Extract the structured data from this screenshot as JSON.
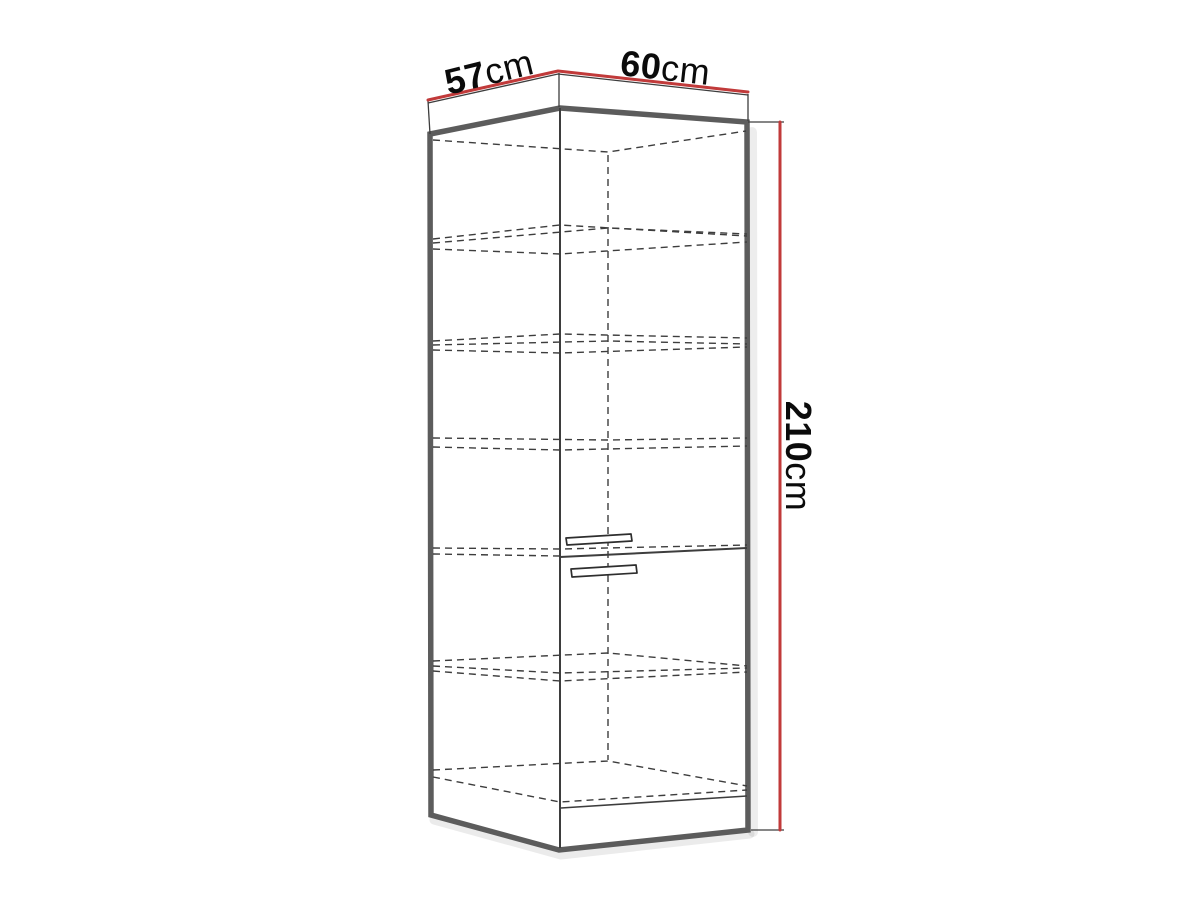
{
  "diagram": {
    "labels": {
      "depth": {
        "value": "57",
        "unit": "cm"
      },
      "width": {
        "value": "60",
        "unit": "cm"
      },
      "height": {
        "value": "210",
        "unit": "cm"
      }
    },
    "colors": {
      "background": "#ffffff",
      "dimension_red": "#c13a3a",
      "outline_gray": "#5c5c5c",
      "edge_dark": "#3d3d3d",
      "text_black": "#0b0b0b"
    }
  }
}
